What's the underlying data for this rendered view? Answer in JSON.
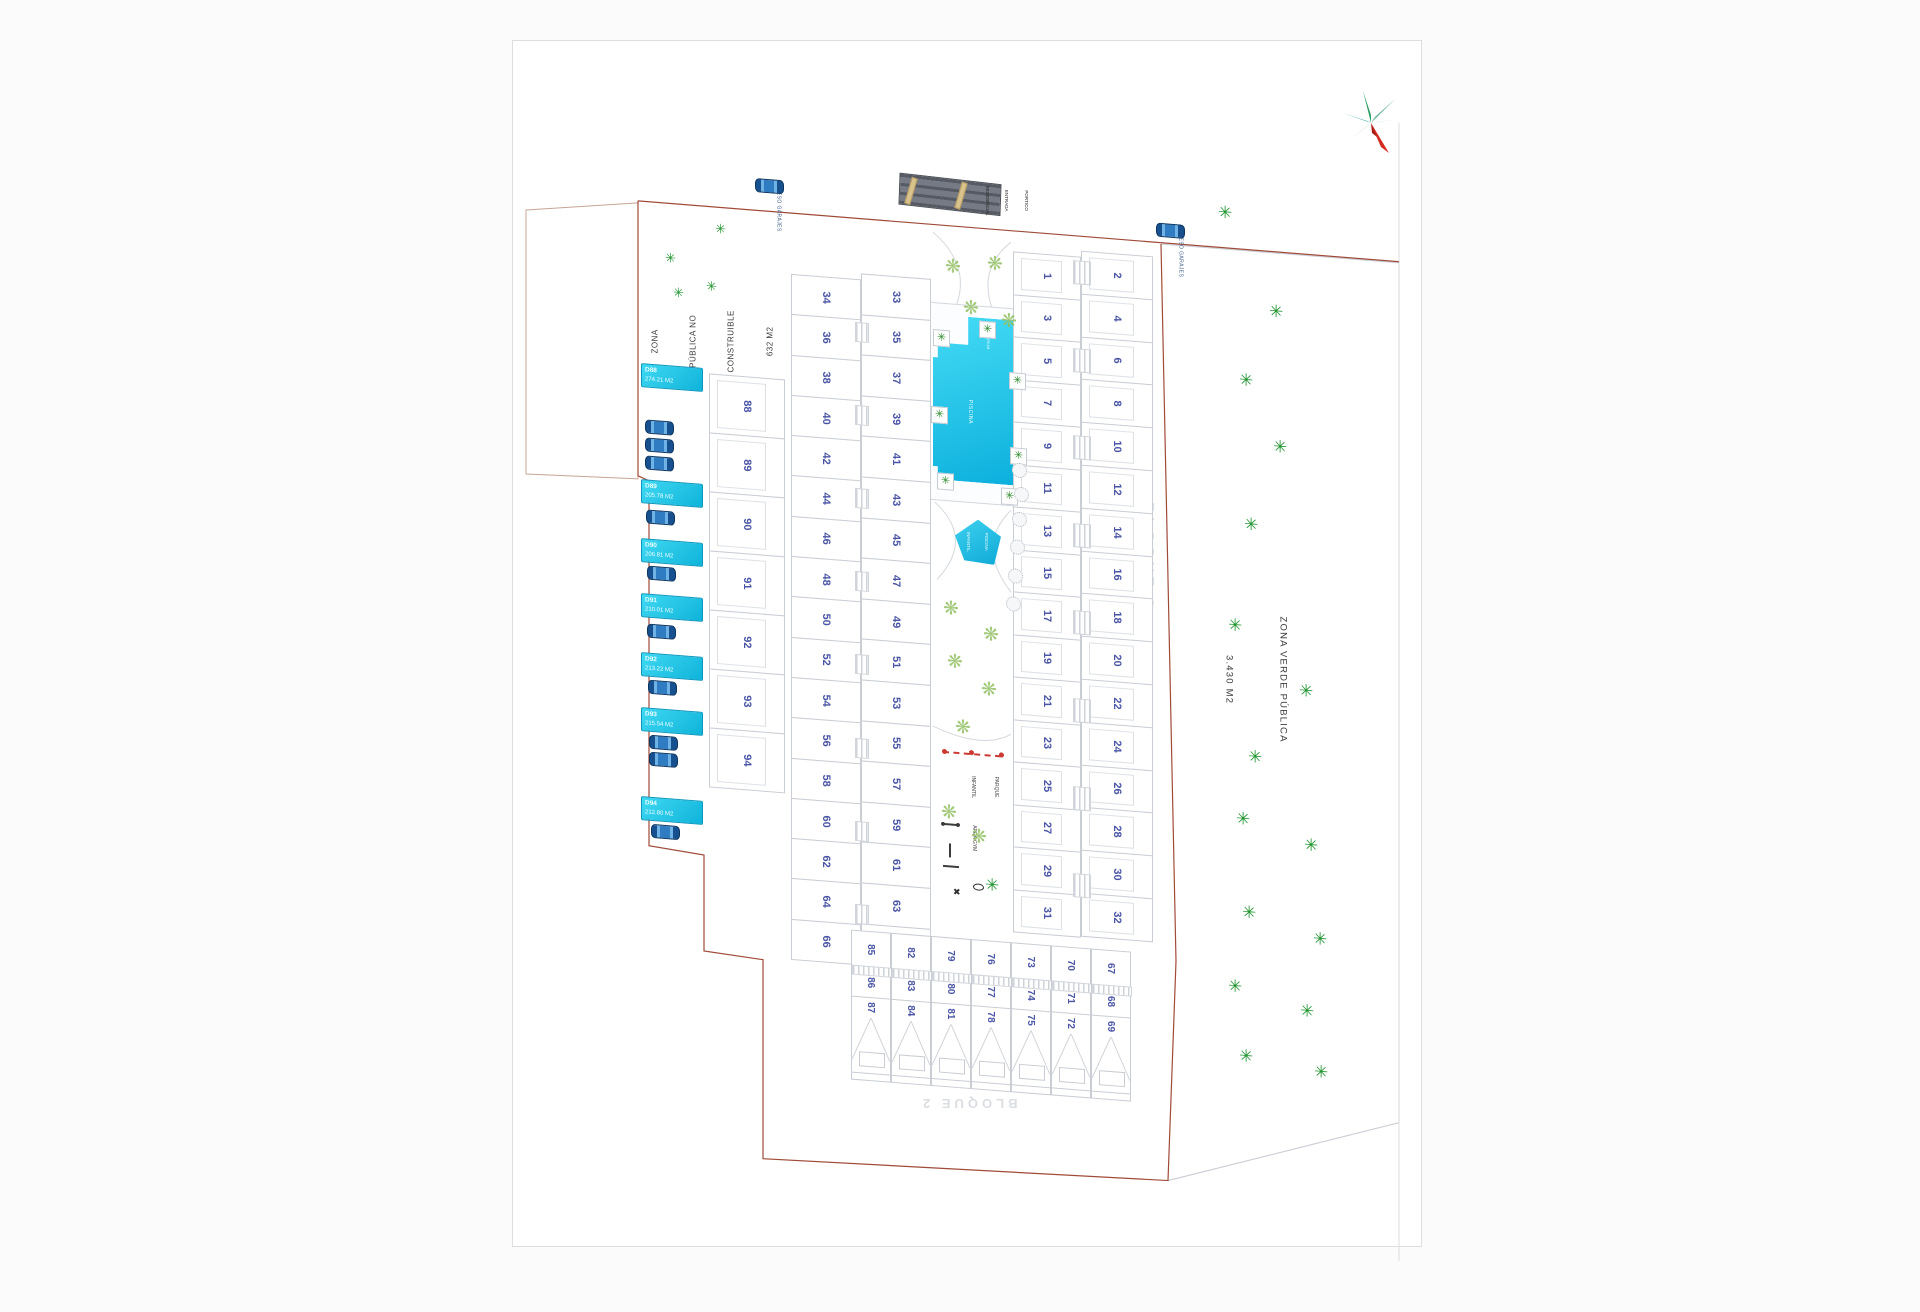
{
  "sheet": {
    "access_garage_labels": [
      "ACCESO GARAJES",
      "ACCESO GARAJES"
    ],
    "portico": {
      "lines": [
        "PORTICO",
        "ENTRADA",
        "RESIDENCIAL"
      ]
    },
    "zona_publica": {
      "lines": [
        "ZONA",
        "PÚBLICA NO",
        "CONSTRUIBLE",
        "632 M2"
      ]
    },
    "zona_verde": {
      "lines": [
        "ZONA VERDE PÚBLICA",
        "3.430 M2"
      ]
    },
    "bloque1_label": "BLOQUE 1",
    "bloque2_label": "BLOQUE 2",
    "bloque3_label": "BLOQUE 3",
    "pool": {
      "label": "PISCINA",
      "solarium_label": "SOLARIUM"
    },
    "kids_pool": {
      "lines": [
        "PISCINA",
        "INFANTIL"
      ]
    },
    "playground": {
      "lines": [
        "PARQUE",
        "INFANTIL"
      ]
    },
    "gym": {
      "label": "AREA GYM"
    },
    "plots": {
      "bloque1_odd": [
        1,
        3,
        5,
        7,
        9,
        11,
        13,
        15,
        17,
        19,
        21,
        23,
        25,
        27,
        29,
        31
      ],
      "bloque1_even": [
        2,
        4,
        6,
        8,
        10,
        12,
        14,
        16,
        18,
        20,
        22,
        24,
        26,
        28,
        30,
        32
      ],
      "mid_even": [
        34,
        36,
        38,
        40,
        42,
        44,
        46,
        48,
        50,
        52,
        54,
        56,
        58,
        60,
        62,
        64,
        66
      ],
      "mid_odd": [
        33,
        35,
        37,
        39,
        41,
        43,
        45,
        47,
        49,
        51,
        53,
        55,
        57,
        59,
        61,
        63,
        65
      ],
      "houses": [
        88,
        89,
        90,
        91,
        92,
        93,
        94
      ],
      "bloque2_cols": [
        [
          85,
          86,
          87
        ],
        [
          82,
          83,
          84
        ],
        [
          79,
          80,
          81
        ],
        [
          76,
          77,
          78
        ],
        [
          73,
          74,
          75
        ],
        [
          70,
          71,
          72
        ],
        [
          67,
          68,
          69
        ]
      ]
    },
    "garage_plots": [
      {
        "code": "D88",
        "area": "274.21 M2"
      },
      {
        "code": "D89",
        "area": "205.78 M2"
      },
      {
        "code": "D90",
        "area": "206.81 M2"
      },
      {
        "code": "D91",
        "area": "210.01 M2"
      },
      {
        "code": "D92",
        "area": "213.22 M2"
      },
      {
        "code": "D93",
        "area": "215.54 M2"
      },
      {
        "code": "D94",
        "area": "212.80 M2"
      }
    ],
    "landscape": {
      "zona_verde_trees": [
        [
          705,
          107
        ],
        [
          756,
          202
        ],
        [
          726,
          273
        ],
        [
          760,
          337
        ],
        [
          731,
          417
        ],
        [
          715,
          519
        ],
        [
          786,
          579
        ],
        [
          735,
          649
        ],
        [
          723,
          712
        ],
        [
          791,
          733
        ],
        [
          729,
          805
        ],
        [
          800,
          826
        ],
        [
          715,
          880
        ],
        [
          787,
          899
        ],
        [
          726,
          949
        ],
        [
          801,
          959
        ]
      ],
      "zona_publica_trees": [
        [
          202,
          165
        ],
        [
          152,
          198
        ],
        [
          160,
          232
        ],
        [
          193,
          223
        ]
      ],
      "amenity_trees": [
        [
          432,
          182
        ],
        [
          474,
          176
        ],
        [
          450,
          222
        ],
        [
          488,
          232
        ],
        [
          430,
          524
        ],
        [
          470,
          547
        ],
        [
          434,
          577
        ],
        [
          468,
          602
        ],
        [
          442,
          642
        ],
        [
          428,
          728
        ],
        [
          458,
          750
        ]
      ],
      "solid_trees": [
        [
          472,
          798
        ]
      ],
      "palms": [
        [
          420,
          255
        ],
        [
          466,
          243
        ],
        [
          496,
          292
        ],
        [
          418,
          332
        ],
        [
          497,
          367
        ],
        [
          424,
          398
        ],
        [
          488,
          408
        ]
      ],
      "bushes": [
        [
          499,
          382
        ],
        [
          501,
          406
        ],
        [
          499,
          431
        ],
        [
          497,
          459
        ],
        [
          495,
          488
        ],
        [
          493,
          516
        ]
      ],
      "garage_cars": [
        [
          132,
          368
        ],
        [
          132,
          386
        ],
        [
          132,
          404
        ],
        [
          133,
          458
        ],
        [
          134,
          514
        ],
        [
          134,
          572
        ],
        [
          135,
          628
        ],
        [
          136,
          683
        ],
        [
          136,
          700
        ],
        [
          138,
          772
        ]
      ],
      "access_cars": [
        [
          242,
          118
        ],
        [
          643,
          131
        ]
      ]
    },
    "colors": {
      "boundary_red": "#a04a38",
      "parcel_gray": "#c9cdd4",
      "plot_number_blue": "#4a55a5",
      "pool_cyan": "#17c3e8",
      "garage_box_cyan": "#1ec9ec",
      "tree_green": "#219530",
      "car_blue": "#1d62a8"
    }
  }
}
